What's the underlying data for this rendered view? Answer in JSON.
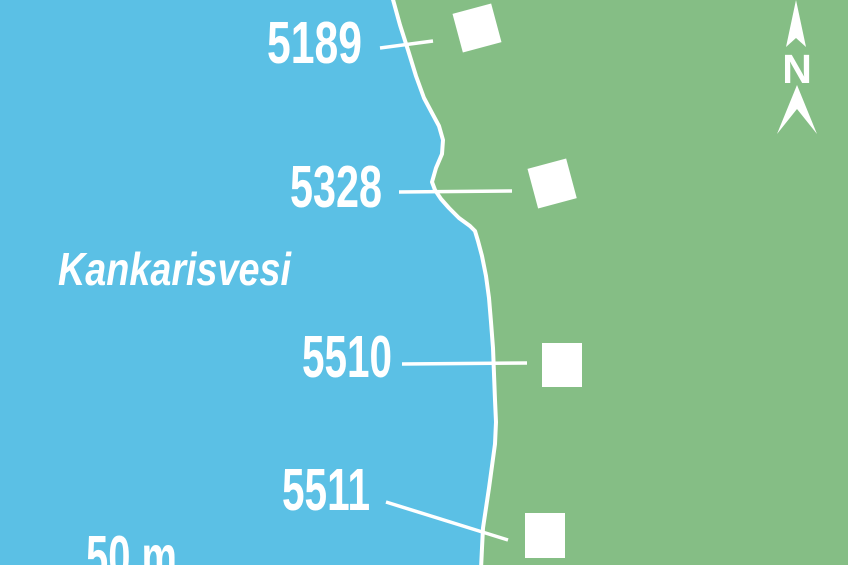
{
  "map": {
    "lake": {
      "name": "Kankarisvesi"
    },
    "markers": [
      {
        "label": "5189"
      },
      {
        "label": "5328"
      },
      {
        "label": "5510"
      },
      {
        "label": "5511"
      }
    ],
    "scale": {
      "label": "50 m"
    },
    "compass": {
      "north_label": "N"
    },
    "colors": {
      "water": "#5bc0e5",
      "land": "#85be85",
      "line": "#ffffff"
    }
  }
}
